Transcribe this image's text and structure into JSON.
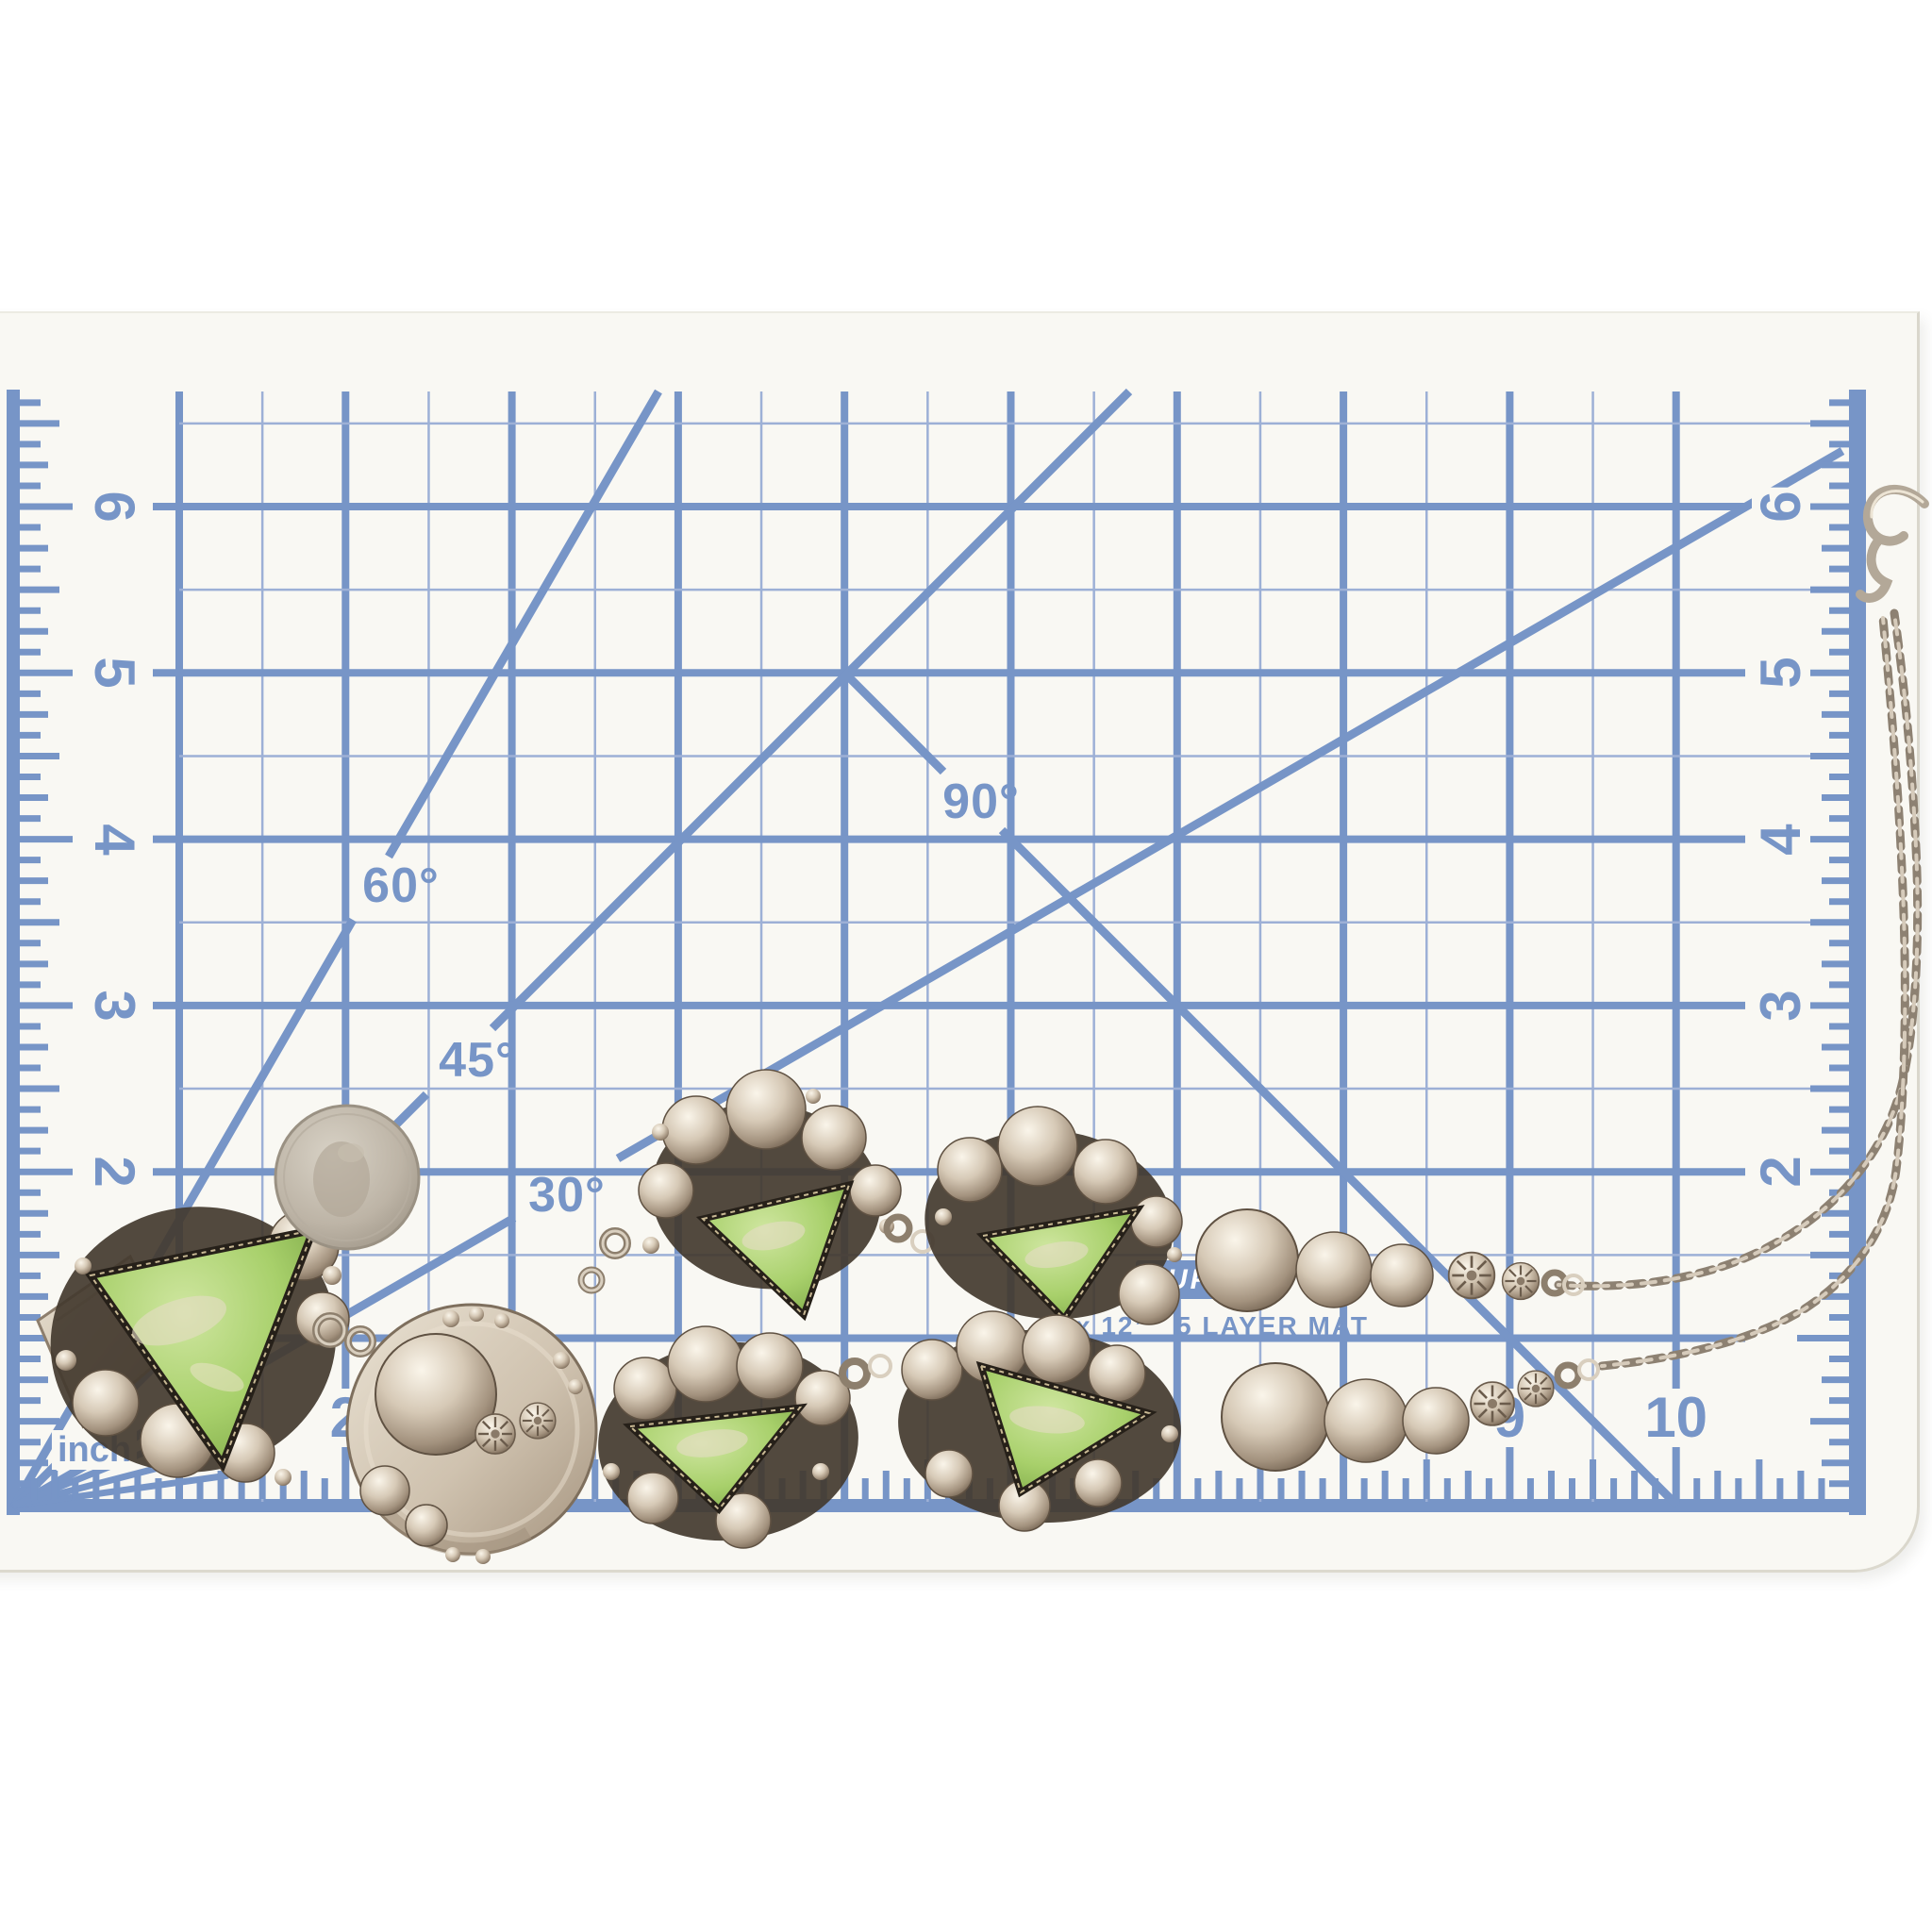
{
  "mat": {
    "type_name": "cutting-mat-grid",
    "print_color": "#7795c7",
    "background_color": "#f9f8f3",
    "left_ruler_numbers": [
      "6",
      "5",
      "4",
      "3",
      "2"
    ],
    "right_ruler_numbers": [
      "6",
      "5",
      "4",
      "3",
      "2"
    ],
    "bottom_ruler_numbers": [
      "2",
      "9",
      "10"
    ],
    "angle_labels": {
      "deg30": "30°",
      "deg45": "45°",
      "deg60": "60°",
      "deg90": "90°"
    },
    "inch_label": "inch",
    "size_label": "x 12”",
    "layer_label": "5 LAYER MAT",
    "banner_fragment": "SUP"
  },
  "objects": {
    "coin": "quarter-dollar-coin",
    "necklace": "silver-squash-blossom-necklace-with-green-gaspeite-stones",
    "stone_color": "#a8d06b",
    "silver_color": "#cfc3b2"
  }
}
